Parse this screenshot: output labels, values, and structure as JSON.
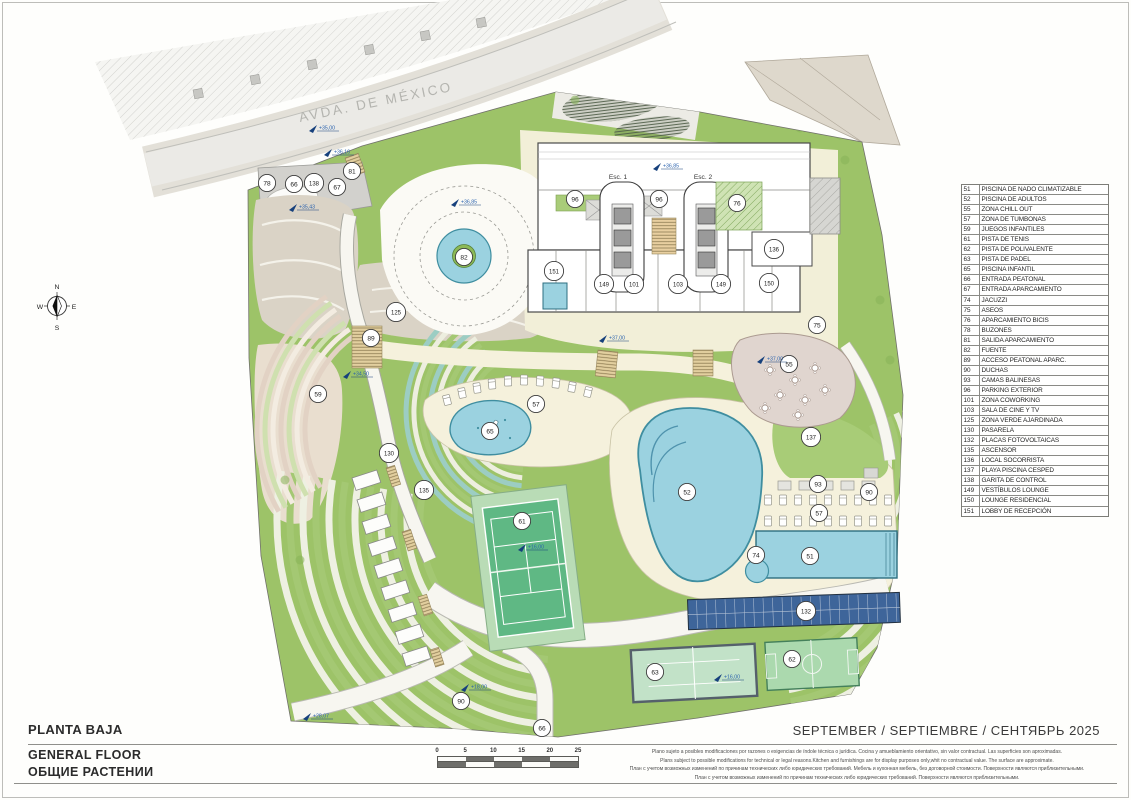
{
  "title_block": {
    "title_primary": "PLANTA BAJA",
    "title_secondary": "GENERAL FLOOR",
    "title_tertiary": "ОБЩИЕ РАСТЕНИИ",
    "date": "SEPTEMBER / SEPTIEMBRE / СЕНТЯБРЬ 2025"
  },
  "street": {
    "name": "AVDA. DE MÉXICO"
  },
  "compass": {
    "n": "N",
    "s": "S",
    "e": "E",
    "w": "W"
  },
  "legend": {
    "items": [
      {
        "num": "51",
        "label": "PISCINA DE NADO CLIMATIZABLE"
      },
      {
        "num": "52",
        "label": "PISCINA DE ADULTOS"
      },
      {
        "num": "55",
        "label": "ZONA CHILL OUT"
      },
      {
        "num": "57",
        "label": "ZONA DE TUMBONAS"
      },
      {
        "num": "59",
        "label": "JUEGOS INFANTILES"
      },
      {
        "num": "61",
        "label": "PISTA DE TENIS"
      },
      {
        "num": "62",
        "label": "PISTA DE POLIVALENTE"
      },
      {
        "num": "63",
        "label": "PISTA DE PADEL"
      },
      {
        "num": "65",
        "label": "PISCINA INFANTIL"
      },
      {
        "num": "66",
        "label": "ENTRADA PEATONAL"
      },
      {
        "num": "67",
        "label": "ENTRADA APARCAMIENTO"
      },
      {
        "num": "74",
        "label": "JACUZZI"
      },
      {
        "num": "75",
        "label": "ASEOS"
      },
      {
        "num": "76",
        "label": "APARCAMIENTO BICIS"
      },
      {
        "num": "78",
        "label": "BUZONES"
      },
      {
        "num": "81",
        "label": "SALIDA APARCAMIENTO"
      },
      {
        "num": "82",
        "label": "FUENTE"
      },
      {
        "num": "89",
        "label": "ACCESO PEATONAL APARC."
      },
      {
        "num": "90",
        "label": "DUCHAS"
      },
      {
        "num": "93",
        "label": "CAMAS BALINESAS"
      },
      {
        "num": "96",
        "label": "PARKING EXTERIOR"
      },
      {
        "num": "101",
        "label": "ZONA COWORKING"
      },
      {
        "num": "103",
        "label": "SALA DE CINE Y TV"
      },
      {
        "num": "125",
        "label": "ZONA VERDE AJARDINADA"
      },
      {
        "num": "130",
        "label": "PASARELA"
      },
      {
        "num": "132",
        "label": "PLACAS FOTOVOLTAICAS"
      },
      {
        "num": "135",
        "label": "ASCENSOR"
      },
      {
        "num": "136",
        "label": "LOCAL SOCORRISTA"
      },
      {
        "num": "137",
        "label": "PLAYA PISCINA CESPED"
      },
      {
        "num": "138",
        "label": "GARITA DE CONTROL"
      },
      {
        "num": "149",
        "label": "VESTÍBULOS LOUNGE"
      },
      {
        "num": "150",
        "label": "LOUNGE RESIDENCIAL"
      },
      {
        "num": "151",
        "label": "LOBBY DE RECEPCIÓN"
      }
    ]
  },
  "plan": {
    "stair_labels": [
      {
        "label": "Esc. 1"
      },
      {
        "label": "Esc. 2"
      }
    ],
    "markers": [
      {
        "num": "78",
        "x": 267,
        "y": 183
      },
      {
        "num": "66",
        "x": 294,
        "y": 184
      },
      {
        "num": "138",
        "x": 314,
        "y": 183
      },
      {
        "num": "67",
        "x": 337,
        "y": 187
      },
      {
        "num": "81",
        "x": 352,
        "y": 171
      },
      {
        "num": "96",
        "x": 575,
        "y": 199
      },
      {
        "num": "96",
        "x": 659,
        "y": 199
      },
      {
        "num": "76",
        "x": 737,
        "y": 203
      },
      {
        "num": "136",
        "x": 774,
        "y": 249
      },
      {
        "num": "151",
        "x": 554,
        "y": 271
      },
      {
        "num": "149",
        "x": 604,
        "y": 284
      },
      {
        "num": "101",
        "x": 634,
        "y": 284
      },
      {
        "num": "103",
        "x": 678,
        "y": 284
      },
      {
        "num": "149",
        "x": 721,
        "y": 284
      },
      {
        "num": "150",
        "x": 769,
        "y": 283
      },
      {
        "num": "75",
        "x": 817,
        "y": 325
      },
      {
        "num": "82",
        "x": 464,
        "y": 257
      },
      {
        "num": "125",
        "x": 396,
        "y": 312
      },
      {
        "num": "89",
        "x": 371,
        "y": 338
      },
      {
        "num": "130",
        "x": 389,
        "y": 453
      },
      {
        "num": "135",
        "x": 424,
        "y": 490
      },
      {
        "num": "59",
        "x": 318,
        "y": 394
      },
      {
        "num": "57",
        "x": 536,
        "y": 404
      },
      {
        "num": "65",
        "x": 490,
        "y": 431
      },
      {
        "num": "55",
        "x": 789,
        "y": 364
      },
      {
        "num": "137",
        "x": 811,
        "y": 437
      },
      {
        "num": "52",
        "x": 687,
        "y": 492
      },
      {
        "num": "93",
        "x": 818,
        "y": 484
      },
      {
        "num": "90",
        "x": 869,
        "y": 492
      },
      {
        "num": "57",
        "x": 819,
        "y": 513
      },
      {
        "num": "74",
        "x": 756,
        "y": 555
      },
      {
        "num": "51",
        "x": 810,
        "y": 556
      },
      {
        "num": "132",
        "x": 806,
        "y": 611
      },
      {
        "num": "61",
        "x": 522,
        "y": 521
      },
      {
        "num": "63",
        "x": 655,
        "y": 672
      },
      {
        "num": "62",
        "x": 792,
        "y": 659
      },
      {
        "num": "90",
        "x": 461,
        "y": 701
      },
      {
        "num": "66",
        "x": 542,
        "y": 728
      }
    ],
    "levels": [
      {
        "label": "+35,00",
        "x": 318,
        "y": 128
      },
      {
        "label": "+36,16",
        "x": 333,
        "y": 152
      },
      {
        "label": "+35,43",
        "x": 298,
        "y": 207
      },
      {
        "label": "+36,85",
        "x": 460,
        "y": 202
      },
      {
        "label": "+36,85",
        "x": 662,
        "y": 166
      },
      {
        "label": "+34,50",
        "x": 352,
        "y": 374
      },
      {
        "label": "+37,00",
        "x": 608,
        "y": 338
      },
      {
        "label": "+37,00",
        "x": 766,
        "y": 359
      },
      {
        "label": "+16,00",
        "x": 527,
        "y": 547
      },
      {
        "label": "+16,00",
        "x": 723,
        "y": 677
      },
      {
        "label": "+18,00",
        "x": 470,
        "y": 687
      },
      {
        "label": "+28,07",
        "x": 312,
        "y": 716
      }
    ]
  },
  "scalebar": {
    "ticks": [
      "0",
      "5",
      "10",
      "15",
      "20",
      "25"
    ]
  },
  "disclaimer": {
    "lines": [
      "Plano sujeto a posibles modificaciones por razones o exigencias de índole técnica o jurídica. Cocina y amueblamiento orientativo, sin valor contractual. Las superficies son aproximadas.",
      "Plans subject to possible modifications for technical or legal reasons.Kitchen and furnishings are for display purposes only,whit no contractual value. The surface are approximate.",
      "План с учетом возможных изменений по причинам технических либо юридических требований. Мебель и кухонная мебель, без договорной стоимости. Поверхности являются приблизительными.",
      "План с учетом возможных изменений по причинам технических либо юридических требований. Поверхности являются приблизительными."
    ]
  },
  "colors": {
    "site_green": "#9dc368",
    "stripe_green": "#a4c873",
    "stripe_light": "#eef0e2",
    "pool_blue": "#9bd2e0",
    "pool_stroke": "#3f8ea0",
    "deck_cream": "#f5f1dc",
    "plaza_cream": "#f2efd8",
    "taupe": "#dad3c6",
    "playground": "#e9decf",
    "chill_taupe": "#e0d5cf",
    "road_gray": "#ebeae6",
    "pad_gray": "#d2d1cd",
    "solar_blue": "#3e659a",
    "marker_blue": "#2a62ae",
    "court_green": "#5fb884",
    "court_pad": "#b9dcb6",
    "building_stroke": "#4a4a4a"
  }
}
